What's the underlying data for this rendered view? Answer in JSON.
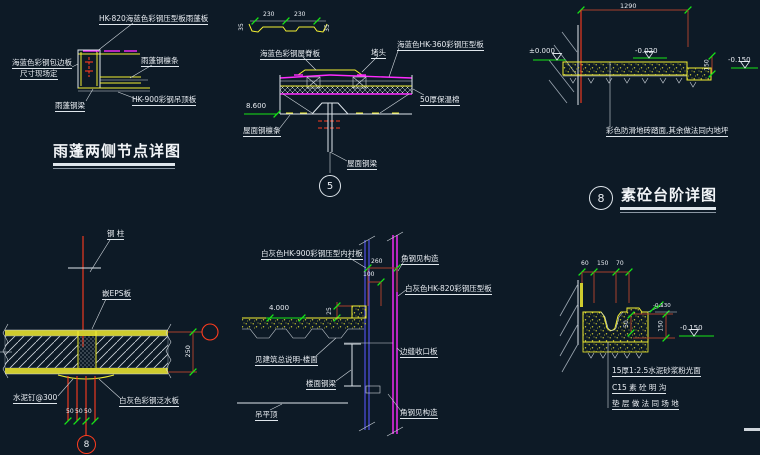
{
  "canvas": {
    "background": "#0d1a26"
  },
  "palette": {
    "white": "#dfe6ec",
    "yellow": "#f4f032",
    "magenta": "#ff2bff",
    "green": "#17e617",
    "red": "#ff3c1e",
    "dim_red": "#a8402c",
    "blue": "#5050e6"
  },
  "details": {
    "canopy": {
      "title": "雨蓬两侧节点详图",
      "label_panel": "HK-820海蓝色彩钢压型板雨蓬板",
      "label_edge_line1": "海蓝色彩钢包边板",
      "label_edge_line2": "尺寸现场定",
      "label_purlin": "雨蓬钢檩条",
      "label_ceiling": "HK-900彩钢吊顶板",
      "label_beam": "雨蓬钢梁"
    },
    "ridge": {
      "bubble": "5",
      "dim_left": "230",
      "dim_right": "230",
      "dim_end_left": "35",
      "dim_end_right": "35",
      "elevation": "8.600",
      "label_cap": "海蓝色彩钢屋脊板",
      "label_plug": "堵头",
      "label_panel": "海蓝色HK-360彩钢压型板",
      "label_insulation": "50厚保温棉",
      "label_purlin": "屋面钢檩条",
      "label_beam": "屋面钢梁"
    },
    "steps": {
      "bubble": "8",
      "title": "素砼台阶详图",
      "dim_total": "1290",
      "dim_riser": "150",
      "elev_zero": "±0.000",
      "elev_mid": "-0.020",
      "elev_low": "-0.150",
      "note": "彩色防滑地砖踏面,其余做法同内地坪"
    },
    "panel_joint": {
      "bubble": "8",
      "label_column": "钢 柱",
      "label_eps": "嵌EPS板",
      "label_nails": "水泥钉@300",
      "label_flashing": "白灰色彩钢泛水板",
      "dim_50a": "50",
      "dim_50b": "50",
      "dim_50c": "50",
      "dim_height": "250"
    },
    "floor_edge": {
      "elevation": "4.000",
      "dim_260": "260",
      "dim_100": "100",
      "dim_25": "25",
      "label_liner": "白灰色HK-900彩钢压型内衬板",
      "label_angle_top": "角钢见构造",
      "label_panel": "白灰色HK-820彩钢压型板",
      "label_closure": "边缝收口板",
      "label_floor": "见建筑总说明-楼面",
      "label_beam": "楼面钢梁",
      "label_ceiling": "吊平顶",
      "label_angle_bottom": "角钢见构造"
    },
    "gutter": {
      "dim_60": "60",
      "dim_150": "150",
      "dim_70": "70",
      "dim_50": "50",
      "dim_depth": "150",
      "elev_small": "-0.130",
      "elev_low": "-0.150",
      "note1": "15厚1:2.5水泥砂浆粉光面",
      "note2": "C15 素 砼 明 沟",
      "note3": "垫 层 做 法 同 场 地"
    }
  }
}
